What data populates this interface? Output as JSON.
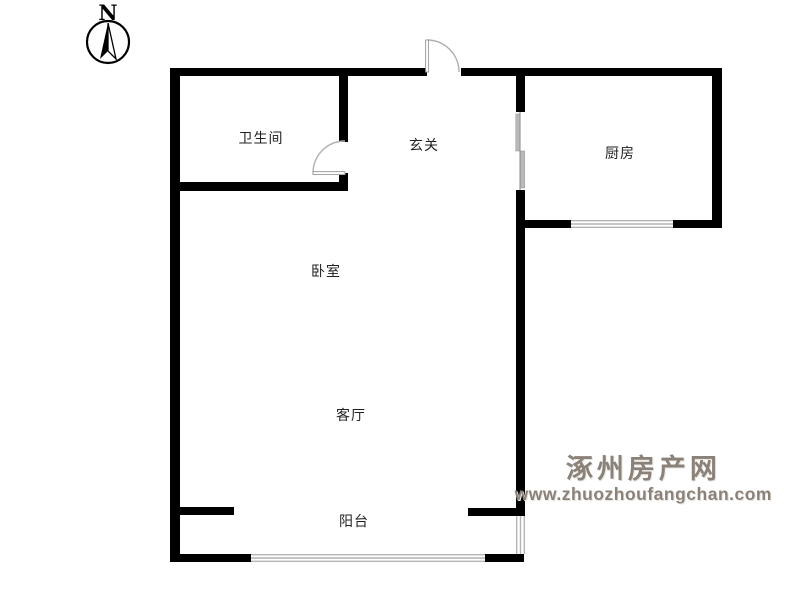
{
  "compass": {
    "label": "N"
  },
  "rooms": [
    {
      "id": "bathroom",
      "label": "卫生间"
    },
    {
      "id": "hallway",
      "label": "玄关"
    },
    {
      "id": "kitchen",
      "label": "厨房"
    },
    {
      "id": "bedroom",
      "label": "卧室"
    },
    {
      "id": "living-room",
      "label": "客厅"
    },
    {
      "id": "balcony",
      "label": "阳台"
    }
  ],
  "watermark": {
    "site_name": "涿州房产网",
    "url": "www.zhuozhoufangchan.com"
  },
  "colors": {
    "background": "#ffffff",
    "wall": "#000000",
    "window_line": "#b4b4b4",
    "door_line": "#b0b0b0",
    "label_text": "#222222",
    "watermark": "#8a8179"
  }
}
